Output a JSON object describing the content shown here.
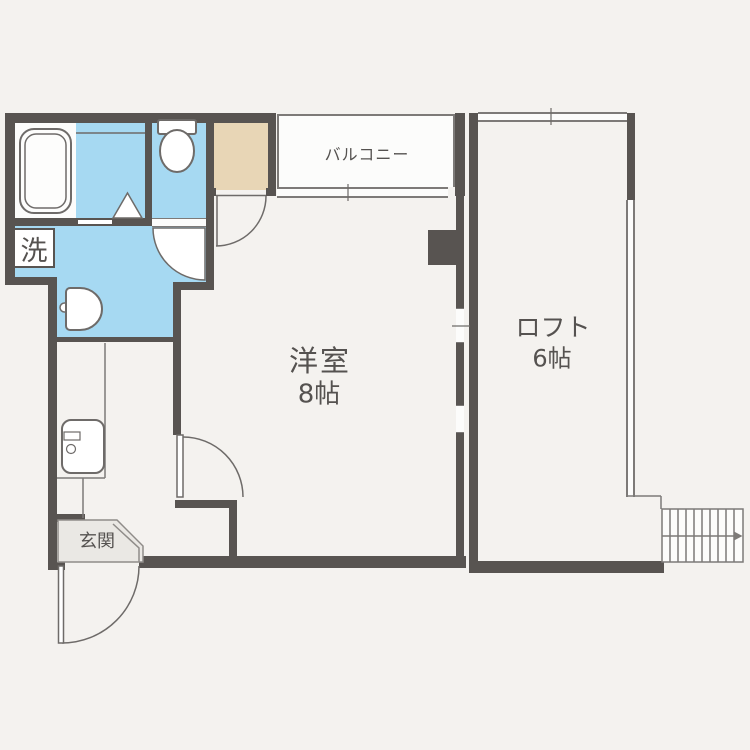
{
  "floorplan": {
    "type": "apartment-floor-plan",
    "labels": {
      "balcony": "バルコニー",
      "room_name": "洋室",
      "room_size": "8帖",
      "loft_name": "ロフト",
      "loft_size": "6帖",
      "entrance": "玄関",
      "laundry": "洗"
    },
    "colors": {
      "wall": "#585451",
      "line": "#7d7a78",
      "wet_area": "#a6d9f2",
      "closet": "#e8d6b6",
      "entrance_floor": "#eae8e4",
      "background": "#f4f2ef",
      "floor": "#fcfcfb",
      "text": "#555250"
    }
  }
}
